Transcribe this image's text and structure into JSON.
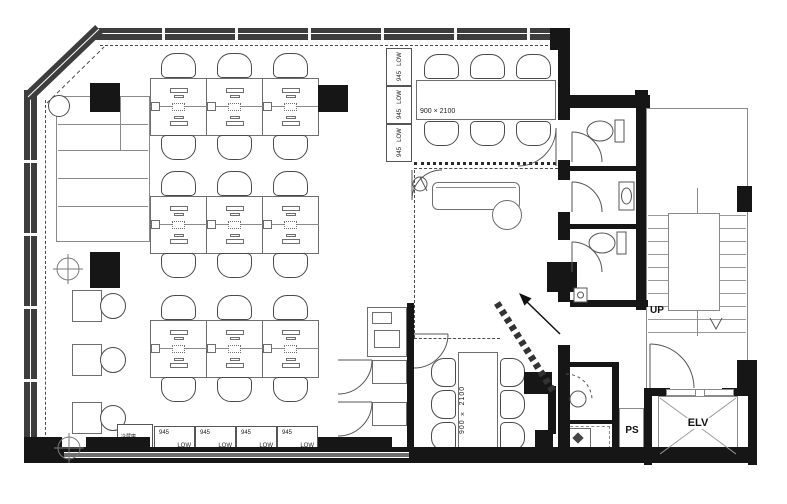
{
  "plan": {
    "meeting_room_top": {
      "table_label": "900 × 2100"
    },
    "meeting_room_bottom": {
      "table_label": "900 × 2100"
    },
    "stairs": {
      "direction_label": "UP"
    },
    "elevator": {
      "label": "ELV"
    },
    "pipe_shaft": {
      "label": "PS"
    },
    "refrigerator": {
      "label": "冷蔵庫"
    },
    "side_cabinets": [
      {
        "height_label": "LOW",
        "size_label": "945"
      },
      {
        "height_label": "LOW",
        "size_label": "945"
      },
      {
        "height_label": "LOW",
        "size_label": "945"
      }
    ],
    "bottom_cabinets": [
      {
        "size_label": "945",
        "height_label": "LOW"
      },
      {
        "size_label": "945",
        "height_label": "LOW"
      },
      {
        "size_label": "945",
        "height_label": "LOW"
      },
      {
        "size_label": "945",
        "height_label": "LOW"
      }
    ]
  },
  "colors": {
    "wall": "#161616",
    "window_frame": "#3d3d3d",
    "line": "#6e6e6e"
  }
}
